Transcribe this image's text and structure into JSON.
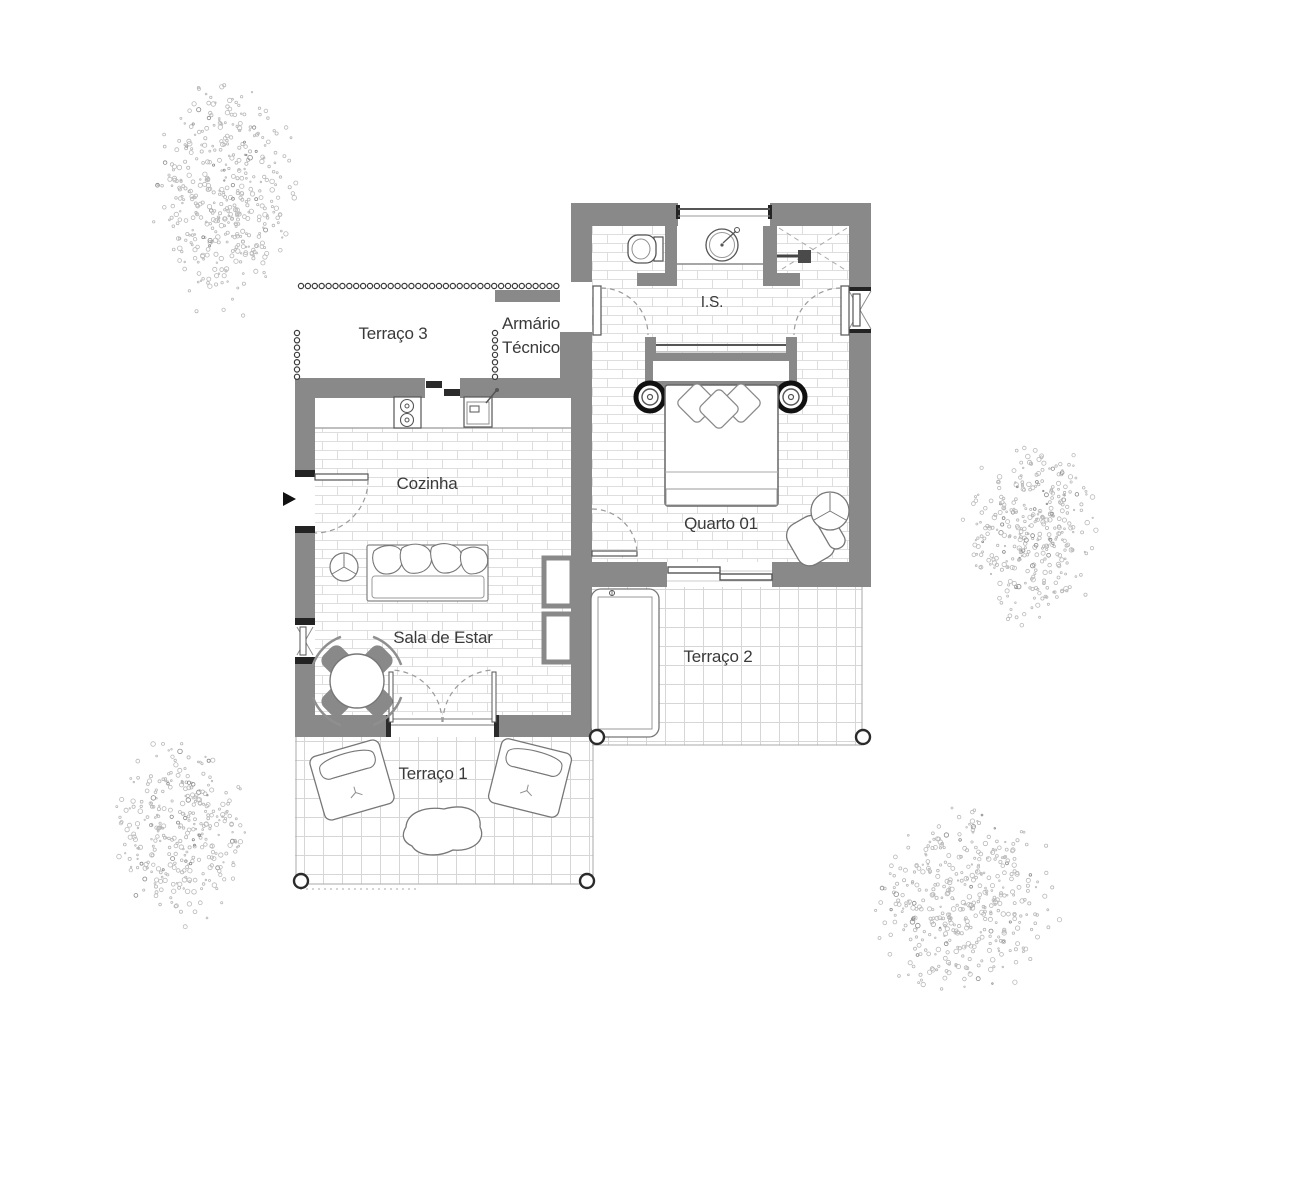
{
  "plan": {
    "rooms": {
      "terraco3": "Terraço 3",
      "armario_line1": "Armário",
      "armario_line2": "Técnico",
      "is": "I.S.",
      "cozinha": "Cozinha",
      "quarto01": "Quarto 01",
      "sala_de_estar": "Sala de Estar",
      "terraco2": "Terraço 2",
      "terraco1": "Terraço 1"
    },
    "colors": {
      "wall": "#898989",
      "jamb": "#232323",
      "outline": "#555555",
      "light_outline": "#8f8f8f",
      "floor_line": "#dedede",
      "grid_line": "#d6d6d6",
      "text": "#3a3a3a",
      "stipple": "#b9b9b9",
      "background": "#ffffff"
    },
    "symbols": [
      "entrance-arrow",
      "double-bed",
      "pillow",
      "bedside-table",
      "wardrobe-headboard",
      "toilet",
      "washbasin",
      "shower",
      "stove",
      "kitchen-sink",
      "counter",
      "sofa",
      "plant",
      "dining-table",
      "dining-chair",
      "wall-niche",
      "sliding-door",
      "door-swing",
      "window",
      "lounger",
      "outdoor-armchair",
      "stone-table",
      "corner-post",
      "bead-line",
      "tree"
    ]
  }
}
